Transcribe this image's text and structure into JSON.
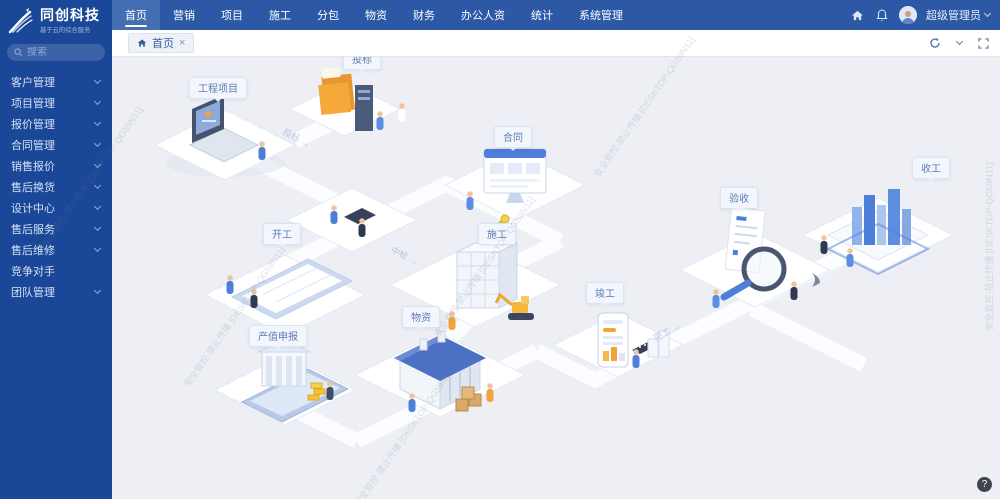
{
  "app": {
    "name": "同创科技",
    "tagline": "基于云的综合服务"
  },
  "sidebar": {
    "search_placeholder": "搜索",
    "items": [
      {
        "label": "客户管理"
      },
      {
        "label": "项目管理"
      },
      {
        "label": "报价管理"
      },
      {
        "label": "合同管理"
      },
      {
        "label": "销售报价"
      },
      {
        "label": "售后换货"
      },
      {
        "label": "设计中心"
      },
      {
        "label": "售后服务"
      },
      {
        "label": "售后维修"
      },
      {
        "label": "竞争对手"
      },
      {
        "label": "团队管理"
      }
    ]
  },
  "header": {
    "nav": [
      {
        "label": "首页"
      },
      {
        "label": "营销"
      },
      {
        "label": "项目"
      },
      {
        "label": "施工"
      },
      {
        "label": "分包"
      },
      {
        "label": "物资"
      },
      {
        "label": "财务"
      },
      {
        "label": "办公人资"
      },
      {
        "label": "统计"
      },
      {
        "label": "系统管理"
      }
    ],
    "user": {
      "name": "超级管理员"
    }
  },
  "tabbar": {
    "active_tab": "首页"
  },
  "canvas": {
    "scene_labels": [
      {
        "text": "工程项目"
      },
      {
        "text": "投标"
      },
      {
        "text": "合同"
      },
      {
        "text": "开工"
      },
      {
        "text": "施工"
      },
      {
        "text": "物资"
      },
      {
        "text": "产值申报"
      },
      {
        "text": "竣工"
      },
      {
        "text": "验收"
      },
      {
        "text": "收工"
      }
    ],
    "path_labels": [
      {
        "text": "投标 →"
      },
      {
        "text": "中标 →"
      },
      {
        "text": "完工 →"
      }
    ]
  },
  "watermark": {
    "text": "安全管控-禁止传播 [DESKTOP-QG59N11]"
  },
  "help": {
    "label": "?"
  }
}
